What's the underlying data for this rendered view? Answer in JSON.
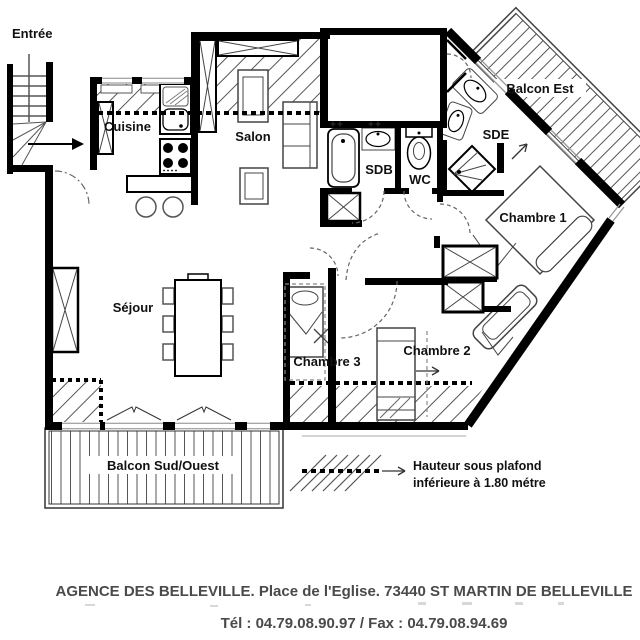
{
  "plan": {
    "rooms": {
      "entree": "Entrée",
      "cuisine": "Cuisine",
      "salon": "Salon",
      "sejour": "Séjour",
      "sdb": "SDB",
      "wc": "WC",
      "sde": "SDE",
      "chambre1": "Chambre 1",
      "chambre2": "Chambre 2",
      "chambre3": "Chambre 3",
      "balcon_est": "Balcon Est",
      "balcon_sud_ouest": "Balcon Sud/Ouest"
    },
    "legend": {
      "line1": "Hauteur sous plafond",
      "line2": "inférieure à 1.80 métre"
    },
    "colors": {
      "wall": "#000000",
      "hatch_line": "#555555",
      "footer_text": "#4a4a4a"
    }
  },
  "footer": {
    "line1": "AGENCE DES BELLEVILLE. Place de l'Eglise. 73440 ST MARTIN DE BELLEVILLE",
    "line2": "Tél : 04.79.08.90.97 / Fax : 04.79.08.94.69"
  }
}
